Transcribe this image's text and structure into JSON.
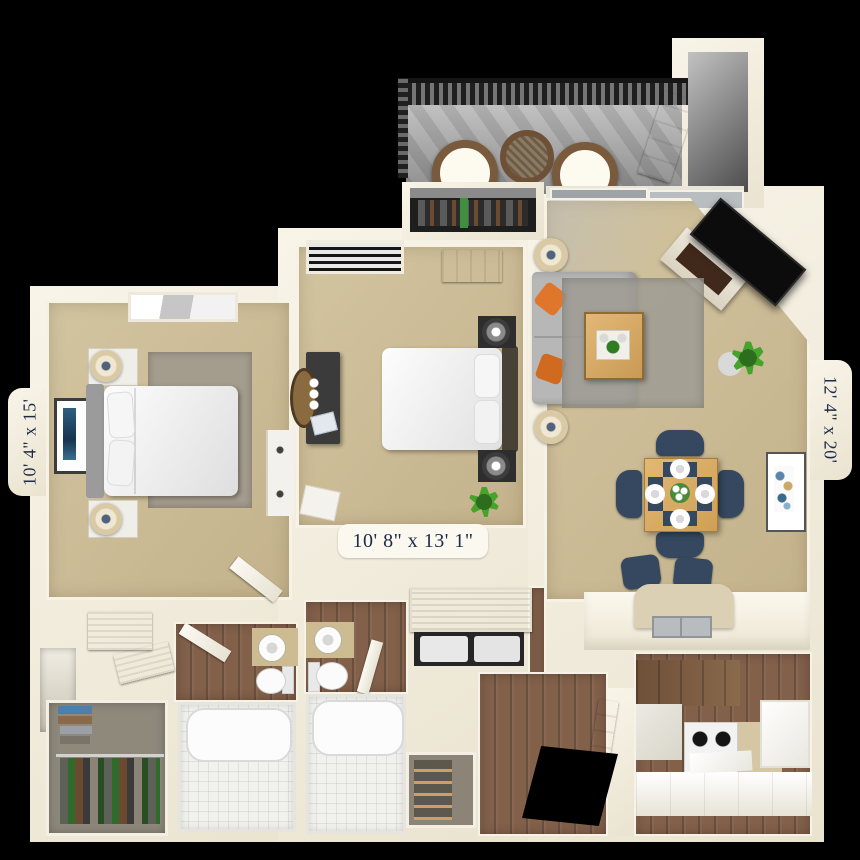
{
  "floorplan": {
    "kind": "3d-apartment-floor-plan",
    "labels": {
      "bedroom_left": "10' 4\" x 15'",
      "bedroom_middle": "10' 8\" x 13' 1\"",
      "living_room": "12' 4\" x 20'"
    },
    "colors": {
      "background": "#000000",
      "wall": "#f1ecdd",
      "carpet": "#c9b994",
      "wood_floor": "#82604a",
      "balcony_floor": "#a6a6a6",
      "railing": "#2e2e2e",
      "sofa": "#b7b7b7",
      "rug": "#a49c8d",
      "accent_pillow": "#e0762c",
      "dining_chair_navy": "#35485f",
      "table_wood": "#d8ab66",
      "plant_green": "#3f9427",
      "tv": "#0e0e0e",
      "label_text": "#1e2b47"
    }
  }
}
